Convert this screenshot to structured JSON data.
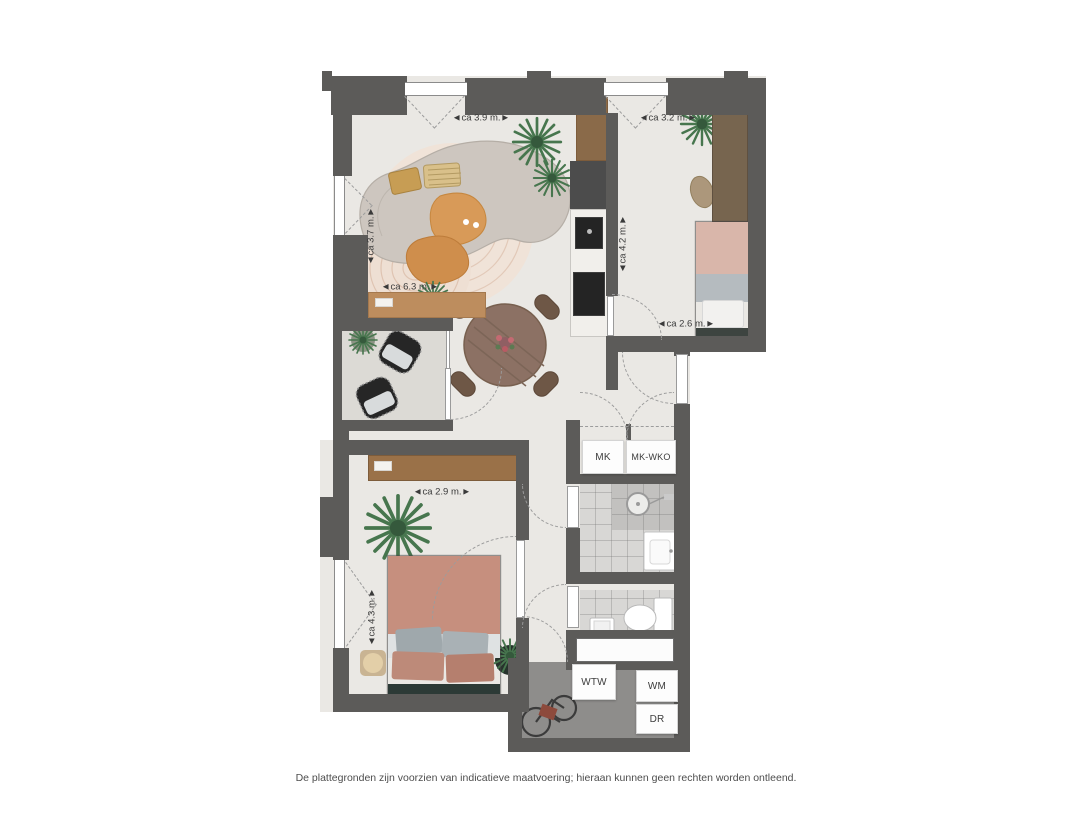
{
  "disclaimer": "De plattegronden zijn voorzien van indicatieve maatvoering; hieraan kunnen geen rechten worden ontleend.",
  "closets": {
    "mk": "MK",
    "mk_wko": "MK-WKO"
  },
  "technical": {
    "wtw": "WTW",
    "wm": "WM",
    "dr": "DR"
  },
  "dimensions": {
    "living_width": "◄ca 3.9 m.►",
    "bedroom2_width": "◄ca 3.2 m.►",
    "living_depth": "◄ca 3.7 m.►",
    "kitchen_wall_length": "◄ca 4.2 m.►",
    "living_length": "◄ca 6.3 m.►",
    "bedroom2_length": "◄ca 2.6 m.►",
    "bedroom1_width": "◄ca 2.9 m.►",
    "bedroom1_depth": "◄ca 4.3 m.►"
  },
  "colors": {
    "wall": "#5c5b59",
    "floor": "#eae8e4",
    "balcony_floor": "#dcdad5",
    "technical_floor": "#8e8d8b",
    "wood": "#96714b",
    "bedding": "#c68f7e"
  }
}
